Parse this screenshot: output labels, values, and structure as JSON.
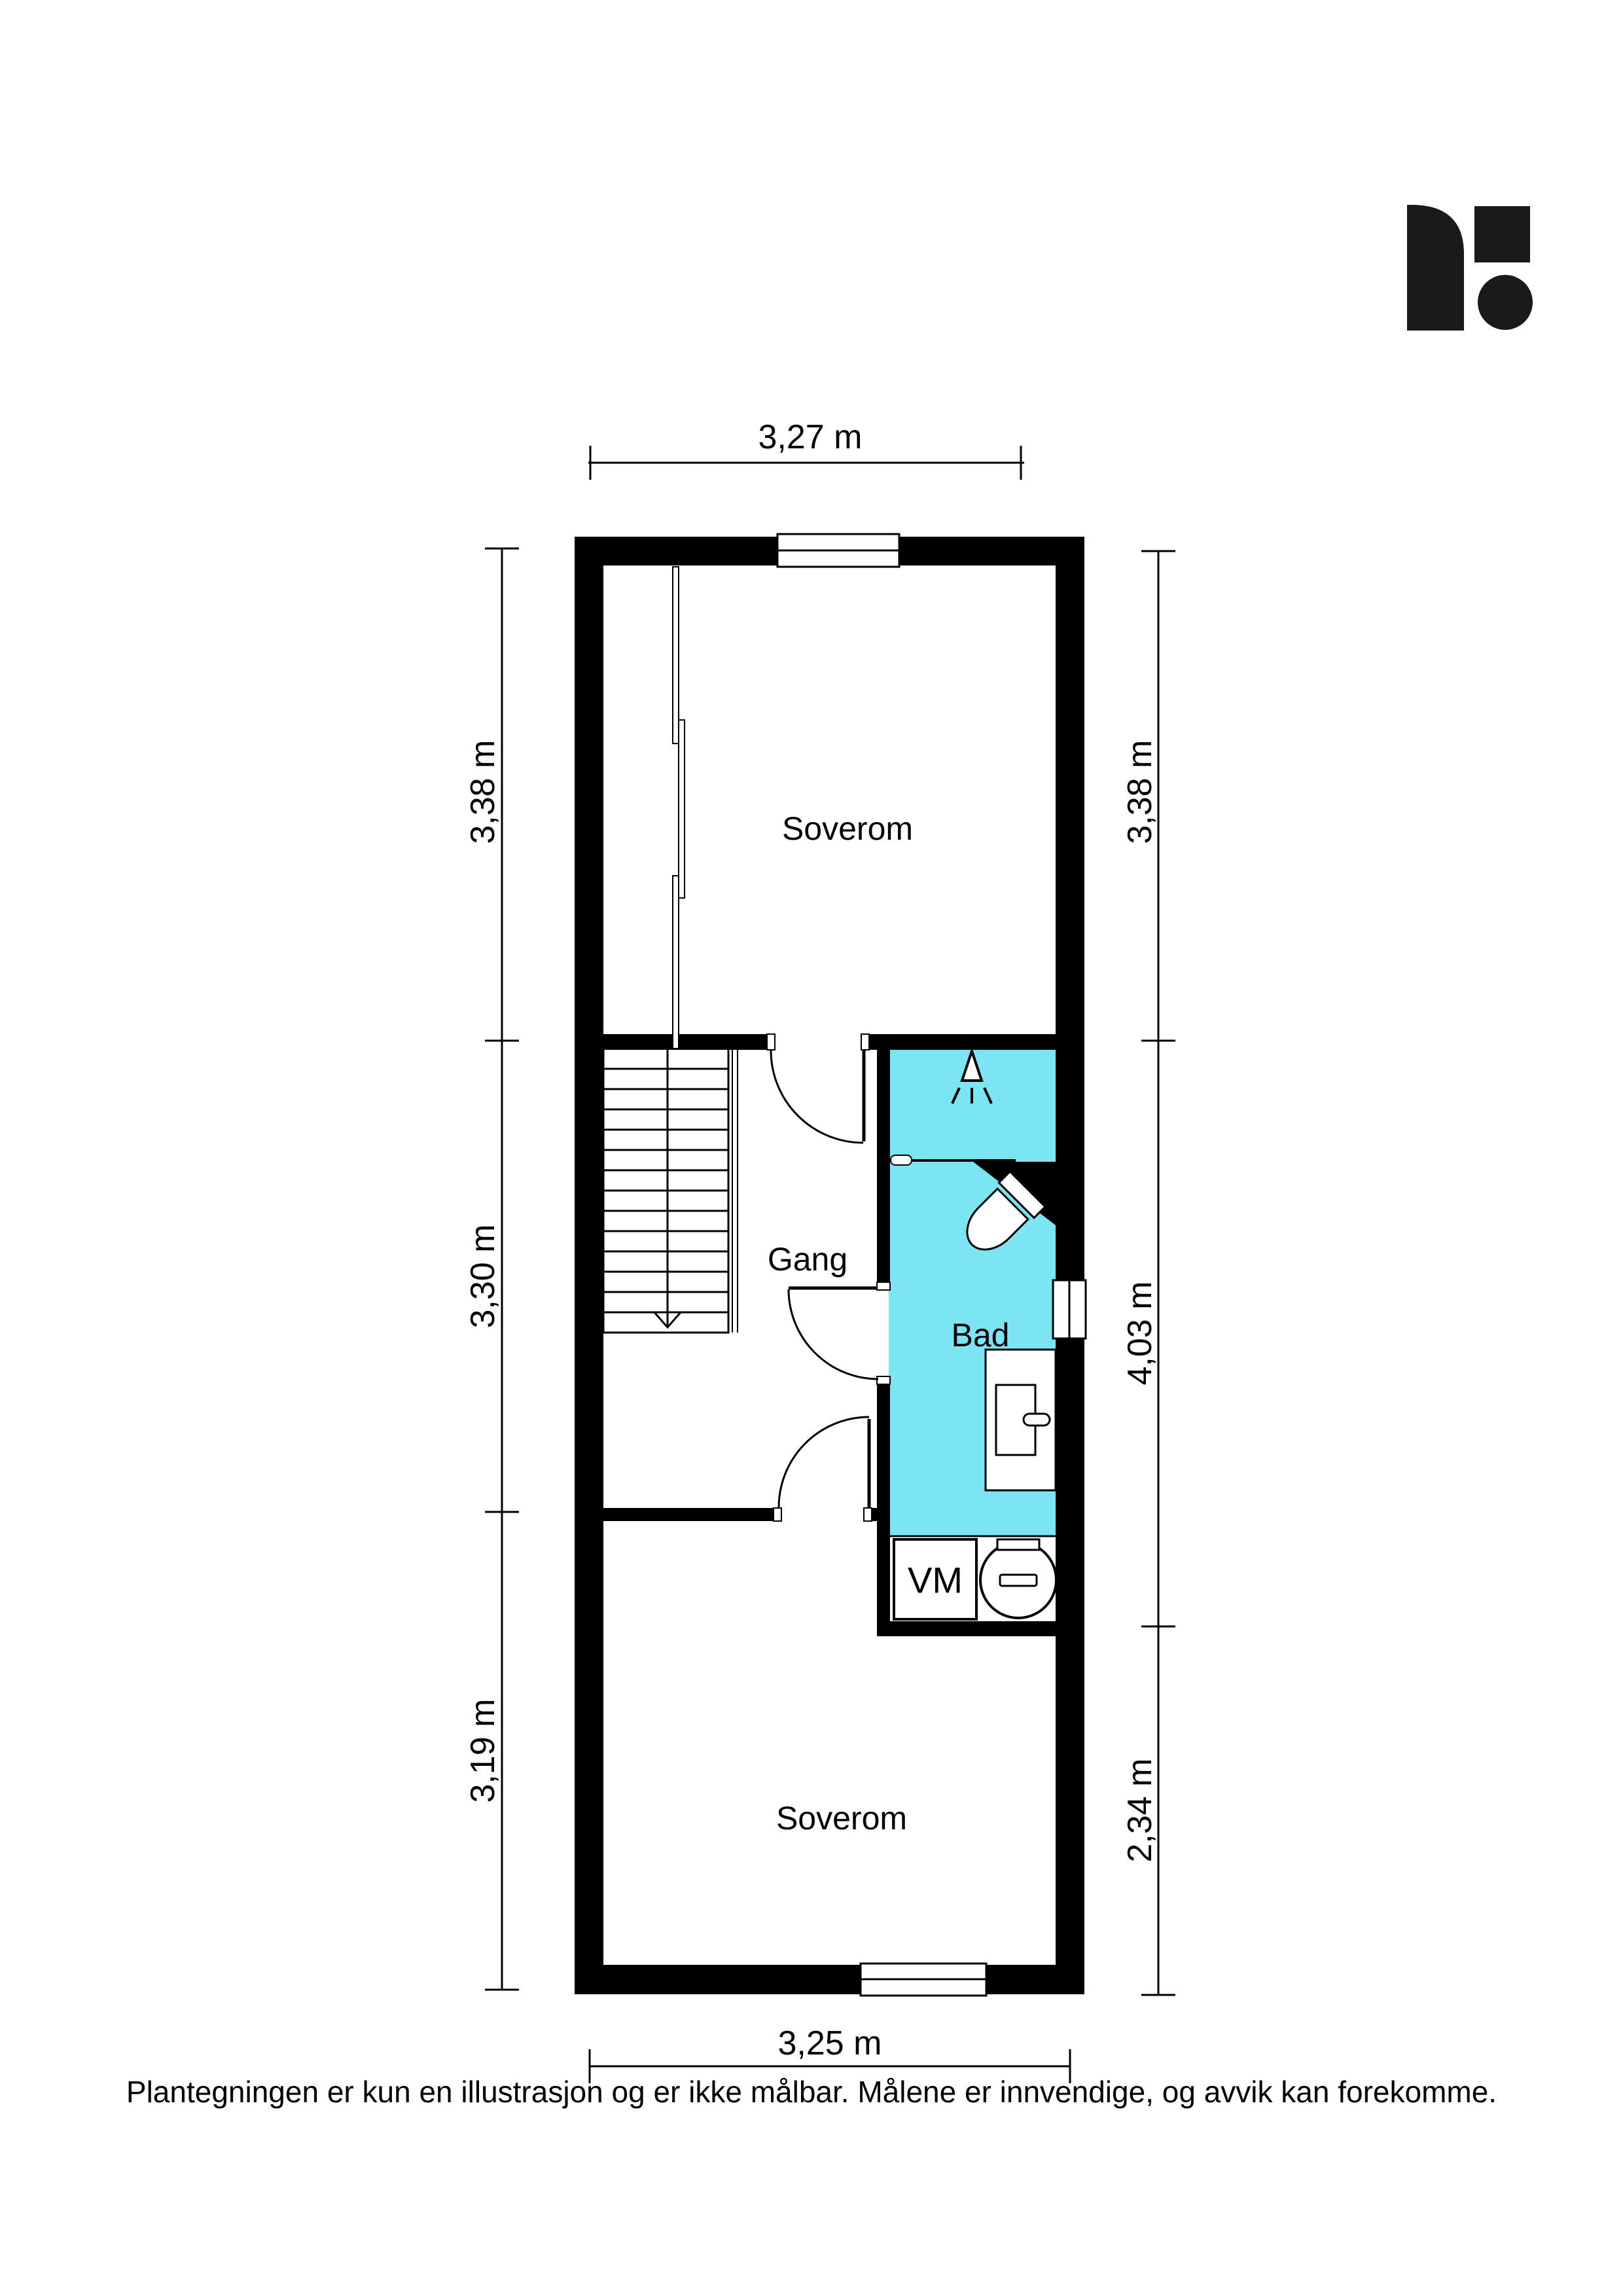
{
  "branding": {
    "logo_color": "#1a1a18",
    "logo_shapes": [
      "rounded-sail",
      "square",
      "circle"
    ]
  },
  "plan": {
    "colors": {
      "wall": "#000000",
      "bathroom_floor": "#7de4f4",
      "floor": "#ffffff",
      "line": "#000000"
    },
    "rooms": [
      {
        "id": "soverom-top",
        "label": "Soverom"
      },
      {
        "id": "gang",
        "label": "Gang"
      },
      {
        "id": "bad",
        "label": "Bad"
      },
      {
        "id": "vm-niche",
        "label": "VM"
      },
      {
        "id": "soverom-bottom",
        "label": "Soverom"
      }
    ],
    "dimensions": {
      "top": {
        "label": "3,27 m"
      },
      "bottom": {
        "label": "3,25 m"
      },
      "left": [
        {
          "label": "3,38 m"
        },
        {
          "label": "3,30 m"
        },
        {
          "label": "3,19 m"
        }
      ],
      "right": [
        {
          "label": "3,38 m"
        },
        {
          "label": "4,03 m"
        },
        {
          "label": "2,34 m"
        }
      ]
    },
    "fixtures": [
      {
        "id": "stairs",
        "direction": "down"
      },
      {
        "id": "shower"
      },
      {
        "id": "toilet"
      },
      {
        "id": "sink-vanity"
      },
      {
        "id": "washing-machine"
      },
      {
        "id": "water-heater"
      },
      {
        "id": "wardrobe-sliding-doors"
      }
    ]
  },
  "footer": {
    "disclaimer": "Plantegningen er kun en illustrasjon og er ikke målbar. Målene er innvendige, og avvik kan forekomme."
  }
}
